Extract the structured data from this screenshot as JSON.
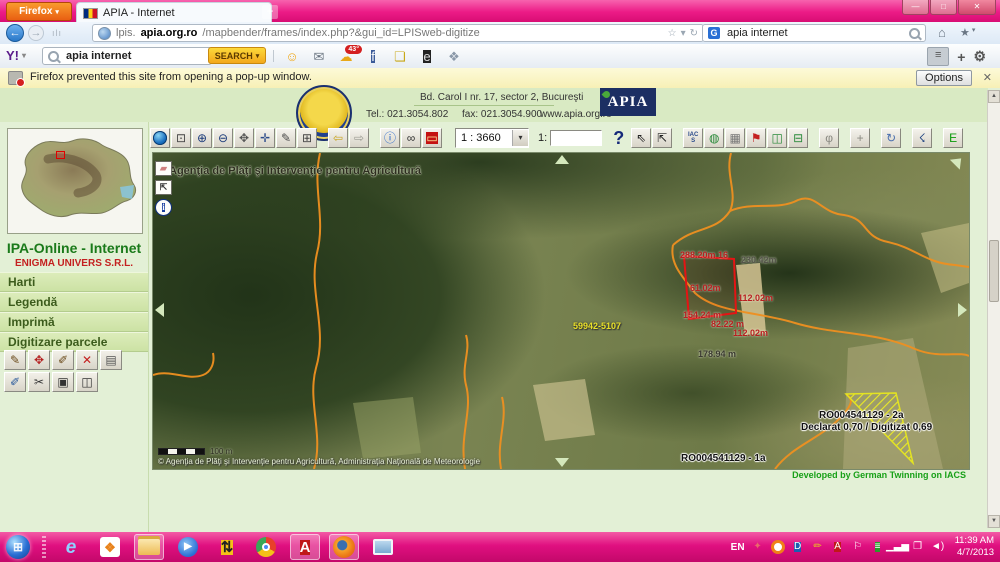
{
  "browser": {
    "firefox_button_label": "Firefox",
    "tab_title": "APIA - Internet",
    "url": {
      "prefix": "lpis.",
      "domain": "apia.org.ro",
      "path": "/mapbender/frames/index.php?&gui_id=LPISweb-digitize"
    },
    "google_search": {
      "icon": "G",
      "value": "apia internet"
    },
    "yahoo": {
      "logo": "Y!",
      "search_value": "apia internet",
      "search_button": "SEARCH",
      "icons": [
        {
          "name": "yahoo-smiley-icon",
          "glyph": "☺",
          "color": "#f0a818"
        },
        {
          "name": "yahoo-mail-icon",
          "glyph": "✉",
          "color": "#6a7480"
        },
        {
          "name": "yahoo-weather-icon",
          "glyph": "☁",
          "color": "#e8a818",
          "badge": "43°"
        },
        {
          "name": "yahoo-facebook-icon",
          "glyph": "f",
          "color": "#fff",
          "bg": "#3a5a98"
        },
        {
          "name": "yahoo-notepad-icon",
          "glyph": "❏",
          "color": "#c8a818"
        },
        {
          "name": "yahoo-ebay-icon",
          "glyph": "e",
          "color": "#ddd",
          "bg": "#222"
        },
        {
          "name": "yahoo-apps-icon",
          "glyph": "❖",
          "color": "#8a98a8"
        }
      ]
    },
    "glyphs": {
      "caret": "▾",
      "plus": "+",
      "back": "←",
      "forward": "→",
      "grip": "ılı",
      "star": "☆",
      "refresh": "↻",
      "home": "⌂",
      "bookmark": "★",
      "menu": "≡",
      "gear": "⚙",
      "close": "✕"
    },
    "window_buttons": [
      {
        "name": "window-minimize-button",
        "glyph": "—"
      },
      {
        "name": "window-maximize-button",
        "glyph": "□"
      },
      {
        "name": "window-close-button",
        "glyph": "✕"
      }
    ]
  },
  "notification": {
    "message": "Firefox prevented this site from opening a pop-up window.",
    "options_label": "Options"
  },
  "site_header": {
    "address": "Bd. Carol I nr. 17, sector 2, Bucureşti",
    "tel": "Tel.: 021.3054.802",
    "fax": "fax: 021.3054.900",
    "website": "www.apia.org.ro",
    "logo": "APIA"
  },
  "sidebar": {
    "app_title": "IPA-Online - Internet",
    "company": "ENIGMA UNIVERS S.R.L.",
    "menu": [
      {
        "name": "menu-harti",
        "label": "Harti"
      },
      {
        "name": "menu-legenda",
        "label": "Legendă"
      },
      {
        "name": "menu-imprima",
        "label": "Imprimă"
      },
      {
        "name": "menu-digitizare-parcele",
        "label": "Digitizare parcele"
      }
    ],
    "tools_row1": [
      {
        "name": "digitize-draw-tool",
        "glyph": "✎",
        "color": "#6a4a1a"
      },
      {
        "name": "digitize-move-vertex-tool",
        "glyph": "✥",
        "color": "#b42020"
      },
      {
        "name": "digitize-edit-tool",
        "glyph": "✐",
        "color": "#6a4a1a"
      },
      {
        "name": "digitize-delete-tool",
        "glyph": "✕",
        "color": "#c42020"
      },
      {
        "name": "digitize-trash-tool",
        "glyph": "▤",
        "color": "#555"
      }
    ],
    "tools_row2": [
      {
        "name": "digitize-snap-tool",
        "glyph": "✐",
        "color": "#2a5a9a"
      },
      {
        "name": "digitize-split-tool",
        "glyph": "✂",
        "color": "#333"
      },
      {
        "name": "digitize-rectangle-tool",
        "glyph": "▣",
        "color": "#333"
      },
      {
        "name": "digitize-merge-tool",
        "glyph": "◫",
        "color": "#333"
      }
    ]
  },
  "map_toolbar": {
    "buttons_left": [
      {
        "name": "tool-overview-globe",
        "glyph": "",
        "special": "globe"
      },
      {
        "name": "tool-zoom-rectangle",
        "glyph": "⊡",
        "color": "#444"
      },
      {
        "name": "tool-zoom-in",
        "glyph": "⊕",
        "color": "#1a3a7a"
      },
      {
        "name": "tool-zoom-out",
        "glyph": "⊖",
        "color": "#1a3a7a"
      },
      {
        "name": "tool-pan-hand",
        "glyph": "✥",
        "color": "#555"
      },
      {
        "name": "tool-recenter",
        "glyph": "✛",
        "color": "#2a4a8a"
      },
      {
        "name": "tool-digitize-pen",
        "glyph": "✎",
        "color": "#4a4a4a"
      },
      {
        "name": "tool-full-extent",
        "glyph": "⊞",
        "color": "#444"
      },
      {
        "name": "tool-history-back",
        "glyph": "⇦",
        "color": "#c8a41e",
        "gap": true
      },
      {
        "name": "tool-history-forward",
        "glyph": "⇨",
        "color": "#9a9a92"
      },
      {
        "name": "tool-feature-info",
        "glyph": "ⓘ",
        "color": "#1b5fc8",
        "gap": true
      },
      {
        "name": "tool-search-binoculars",
        "glyph": "∞",
        "color": "#333"
      },
      {
        "name": "tool-measure-red",
        "glyph": "▭",
        "color": "#ffe89e",
        "bg": "#c41212"
      }
    ],
    "scale_select": "1 : 3660",
    "scale_label": "1:",
    "scale_input_value": "",
    "help": "?",
    "buttons_right": [
      {
        "name": "tool-select-arrow",
        "glyph": "⇖",
        "color": "#222"
      },
      {
        "name": "tool-select-shape",
        "glyph": "⇱",
        "color": "#222"
      },
      {
        "name": "tool-iacs",
        "glyph": "IACS",
        "small": true,
        "color": "#2a4a8a",
        "gap": true
      },
      {
        "name": "tool-wms-globe-edit",
        "glyph": "◍",
        "color": "#2a8a3a"
      },
      {
        "name": "tool-grid",
        "glyph": "▦",
        "color": "#777"
      },
      {
        "name": "tool-flag",
        "glyph": "⚑",
        "color": "#c42020"
      },
      {
        "name": "tool-wms-globe-tiles",
        "glyph": "◫",
        "color": "#2a8a3a"
      },
      {
        "name": "tool-wms-globe-add",
        "glyph": "⊟",
        "color": "#2a8a3a"
      },
      {
        "name": "tool-session-pin",
        "glyph": "φ",
        "color": "#8a8a82",
        "gap": true
      },
      {
        "name": "tool-coordinates-plus",
        "glyph": "+",
        "color": "#8a8a82",
        "gap": true
      },
      {
        "name": "tool-refresh-map",
        "glyph": "↻",
        "color": "#4a6fae",
        "gap": true
      },
      {
        "name": "tool-gps-satellite",
        "glyph": "☇",
        "color": "#1b3f7e",
        "gap": true
      },
      {
        "name": "tool-edit-mode",
        "glyph": "E",
        "color": "#0a9a0a",
        "gap": true
      }
    ]
  },
  "map": {
    "watermark": "Agenţia de Plăţi şi Intervenţie pentru Agricultură",
    "side_buttons": [
      {
        "name": "map-eraser-button",
        "glyph": "▰",
        "color": "#d08080"
      },
      {
        "name": "map-select-box-button",
        "glyph": "⇱",
        "color": "#333"
      },
      {
        "name": "map-info-button",
        "glyph": "i",
        "color": "#fff",
        "bg": "#1a3fa0",
        "round": true
      }
    ],
    "labels": [
      {
        "name": "measurement-label",
        "text": "288.20m 16",
        "x": 527,
        "y": 97,
        "color": "#b82020"
      },
      {
        "name": "measurement-label",
        "text": "230.42m",
        "x": 588,
        "y": 102,
        "color": "#55554a"
      },
      {
        "name": "measurement-label",
        "text": "61.02m",
        "x": 537,
        "y": 130,
        "color": "#b82020"
      },
      {
        "name": "measurement-label",
        "text": "112.02m",
        "x": 585,
        "y": 140,
        "color": "#b82020"
      },
      {
        "name": "measurement-label",
        "text": "154.24 m",
        "x": 530,
        "y": 157,
        "color": "#b82020"
      },
      {
        "name": "measurement-label",
        "text": "82.22 m",
        "x": 558,
        "y": 166,
        "color": "#b82020"
      },
      {
        "name": "measurement-label",
        "text": "112.02m",
        "x": 580,
        "y": 175,
        "color": "#b82020"
      },
      {
        "name": "measurement-label",
        "text": "178.94 m",
        "x": 545,
        "y": 196,
        "color": "#3a3a30"
      },
      {
        "name": "physical-block-id",
        "text": "59942-5107",
        "x": 420,
        "y": 168,
        "color": "#e8e028",
        "halo": "dark"
      },
      {
        "name": "parcel-2a-id",
        "text": "RO004541129 - 2a",
        "x": 666,
        "y": 257,
        "color": "#111",
        "big": true
      },
      {
        "name": "parcel-2a-areas",
        "text": "Declarat 0,70 / Digitizat 0,69",
        "x": 648,
        "y": 269,
        "color": "#111",
        "big": true
      },
      {
        "name": "parcel-1a-id",
        "text": "RO004541129 - 1a",
        "x": 528,
        "y": 300,
        "color": "#111",
        "big": true
      }
    ],
    "scalebar_label": "100 m",
    "copyright": "© Agenţia de Plăţi şi Intervenţie pentru Agricultură, Administraţia Naţională de Meteorologie",
    "credit": "Developed by German Twinning on IACS"
  },
  "taskbar": {
    "apps": [
      {
        "name": "start-button",
        "special": "orb",
        "glyph": "⊞"
      },
      {
        "name": "taskbar-grip",
        "special": "grip"
      },
      {
        "name": "app-internet-explorer",
        "special": "ie",
        "glyph": "e"
      },
      {
        "name": "app-office",
        "special": "office",
        "glyph": "❖"
      },
      {
        "name": "app-windows-explorer",
        "special": "folder",
        "active": true
      },
      {
        "name": "app-media-player",
        "special": "wmp",
        "glyph": "▶",
        "color": "#fff"
      },
      {
        "name": "app-updown-arrows",
        "glyph": "⇅",
        "color": "#222",
        "bg": "#f4c018",
        "round": true
      },
      {
        "name": "app-chrome",
        "special": "chrome"
      },
      {
        "name": "app-adobe-reader",
        "glyph": "A",
        "color": "#fff",
        "bg": "#c01818",
        "active": true
      },
      {
        "name": "app-firefox",
        "special": "firefox",
        "active": true
      },
      {
        "name": "app-image-viewer",
        "special": "photo",
        "active": false
      }
    ],
    "language": "EN",
    "tray": [
      {
        "name": "tray-messenger-icon",
        "glyph": "✦",
        "color": "#e86a6a"
      },
      {
        "name": "tray-download-icon",
        "special": "ring"
      },
      {
        "name": "tray-app-d-icon",
        "glyph": "D",
        "color": "#fff",
        "bg": "#1a5fb0"
      },
      {
        "name": "tray-pencil-icon",
        "glyph": "✏",
        "color": "#e8c81e"
      },
      {
        "name": "tray-adobe-icon",
        "glyph": "A",
        "color": "#fff",
        "bg": "#c01818"
      },
      {
        "name": "tray-flag-icon",
        "glyph": "⚐",
        "color": "#fff"
      },
      {
        "name": "tray-power-icon",
        "glyph": "≡",
        "color": "#fff",
        "bg": "#2a9a2a"
      },
      {
        "name": "tray-network-icon",
        "glyph": "▁▃▅",
        "color": "#fff"
      },
      {
        "name": "tray-clipboard-icon",
        "glyph": "❐",
        "color": "#fff"
      },
      {
        "name": "tray-volume-icon",
        "glyph": "◄)",
        "color": "#fff"
      }
    ],
    "time": "11:39 AM",
    "date": "4/7/2013"
  }
}
